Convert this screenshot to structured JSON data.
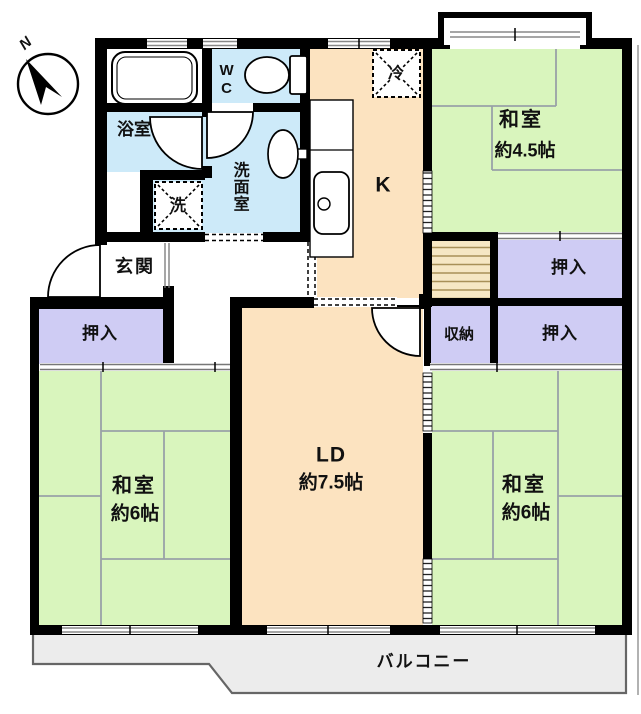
{
  "title": "apartment-floor-plan",
  "compass": {
    "label": "N"
  },
  "rooms": {
    "bathroom": {
      "label": "浴室"
    },
    "wc": {
      "label": "WC"
    },
    "washroom": {
      "label": "洗面室"
    },
    "laundry": {
      "label": "洗"
    },
    "fridge": {
      "label": "冷"
    },
    "entrance": {
      "label": "玄関"
    },
    "kitchen": {
      "label": "K"
    },
    "washitsu_ne": {
      "label": "和室",
      "size": "約4.5帖"
    },
    "closet_ne": {
      "label": "押入"
    },
    "closet_e": {
      "label": "押入"
    },
    "closet_w": {
      "label": "押入"
    },
    "storage": {
      "label": "収納"
    },
    "living": {
      "label": "LD",
      "size": "約7.5帖"
    },
    "washitsu_sw": {
      "label": "和室",
      "size": "約6帖"
    },
    "washitsu_se": {
      "label": "和室",
      "size": "約6帖"
    },
    "balcony": {
      "label": "バルコニー"
    }
  },
  "colors": {
    "wall": "#000000",
    "green": "#d9f5bd",
    "peach": "#fce3c0",
    "purple": "#cfccf4",
    "blue": "#cdeaf9",
    "cream": "#f6e7c4",
    "balcony": "#ececec",
    "tatline": "#99a1a7",
    "fusuma": "#777777",
    "ink": "#111111"
  }
}
